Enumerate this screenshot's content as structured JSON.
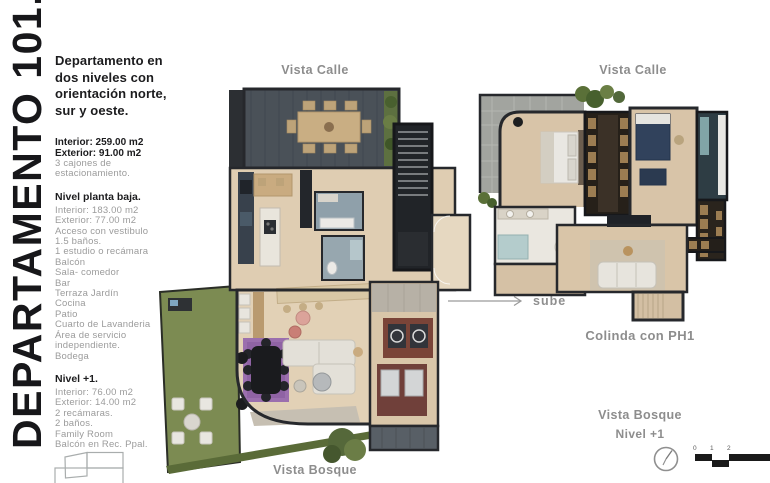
{
  "page": {
    "title_vertical": "DEPARTAMENTO 101."
  },
  "info": {
    "heading": "Departamento en dos niveles con orientación norte, sur y oeste.",
    "area_interior": "Interior: 259.00 m2",
    "area_exterior": "Exterior: 91.00 m2",
    "parking": "3 cajones de estacionamiento.",
    "planta_baja": {
      "title": "Nivel planta baja.",
      "items": [
        "Interior: 183.00 m2",
        "Exterior: 77.00 m2",
        "Acceso con vestibulo",
        "1.5 baños.",
        "1 estudio o recámara",
        "Balcón",
        "Sala- comedor",
        "Bar",
        "Terraza Jardín",
        "Cocina",
        "Patio",
        "Cuarto de Lavanderia",
        "Área de servicio independiente.",
        "Bodega"
      ]
    },
    "nivel_1": {
      "title": "Nivel +1.",
      "items": [
        "Interior: 76.00 m2",
        "Exterior: 14.00 m2",
        "2 recámaras.",
        "2 baños.",
        "Family Room",
        "Balcón en Rec. Ppal."
      ]
    }
  },
  "plans": {
    "planta_baja": {
      "label_top": "Vista Calle",
      "label_bottom": "Vista Bosque"
    },
    "nivel_1": {
      "label_top": "Vista Calle",
      "label_adjacent": "Colinda con PH1",
      "label_bottom": "Vista Bosque",
      "label_level": "Nivel +1"
    }
  },
  "annotations": {
    "sube": "sube"
  },
  "scale_bar": {
    "ticks": [
      "0",
      "1",
      "2"
    ]
  },
  "colors": {
    "text_dark": "#17171a",
    "text_gray": "#9b9b9b",
    "label_gray": "#8d8d8d",
    "wall": "#26282c",
    "floor_beige": "#dfcdb2",
    "terrace_deck": "#4a5158",
    "concrete_terrace": "#a2a49f",
    "garden_green": "#7c8b52",
    "rug_purple": "#9b6fae",
    "kitchen_cabinet": "#38414c",
    "laundry_red": "#7a4438"
  }
}
